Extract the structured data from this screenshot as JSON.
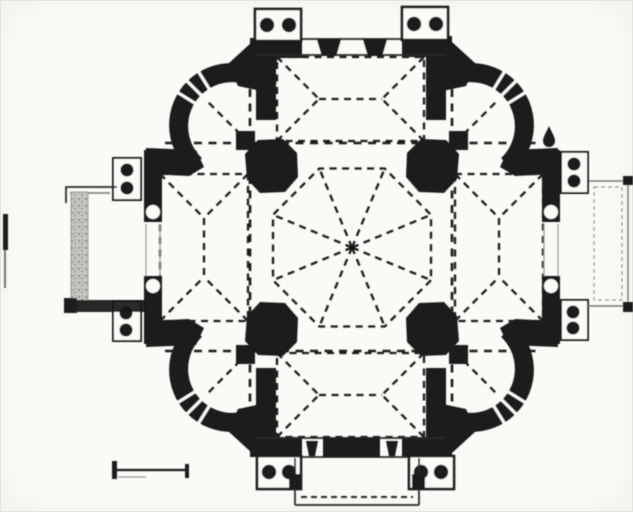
{
  "figure": {
    "type": "architectural-floor-plan",
    "description": "Scanned black-and-white floor plan of a centrally planned quatrefoil Greek-cross church: a central octagonal domed bay carried on four octagonal piers, four cross-vaulted arms shown with dashed vault lines, four semicircular corner chapels with thick curved walls and triple window mullions, twin-column porticoes on all four sides, a rectangular open porch on the left, right and bottom, a scale bar at lower left and a stray scan mark at the far left edge.",
    "canvas": {
      "width": 633,
      "height": 512
    },
    "colors": {
      "paper": "#fafaf7",
      "ink": "#1a1a1a",
      "thin": "#2a2a2a",
      "mid_gray": "#777777",
      "light_gray": "#9a9a9a",
      "hatch": "#c6c6bd",
      "border": "#e3e3e0"
    }
  },
  "plan": {
    "center": {
      "x": 352,
      "y": 247.5
    },
    "central_dome": {
      "shape": "octagon",
      "ribs": 8,
      "line_style": "dashed",
      "apothem": 79
    },
    "piers": {
      "count": 4,
      "shape": "octagonal-with-corner-nub"
    },
    "arms": {
      "count": 4,
      "vault_lines": "dashed envelope cross-vault with ridge"
    },
    "corner_chapels": {
      "count": 4,
      "outer_radius": 62,
      "inner_radius": 44,
      "window_mullions_each": 3
    },
    "porticoes": {
      "count": 4,
      "column_pairs_each": 2,
      "total_column_dots": 16
    },
    "side_porches": {
      "left": "hatched-wall porch",
      "right": "open stepped porch",
      "bottom": "projecting porch with dashed step line"
    }
  },
  "scale_bar": {
    "present": true,
    "x": 112,
    "y": 470,
    "length_px": 77,
    "end_ticks": 2
  },
  "stray_mark": {
    "present": true,
    "position": "far-left-edge"
  }
}
